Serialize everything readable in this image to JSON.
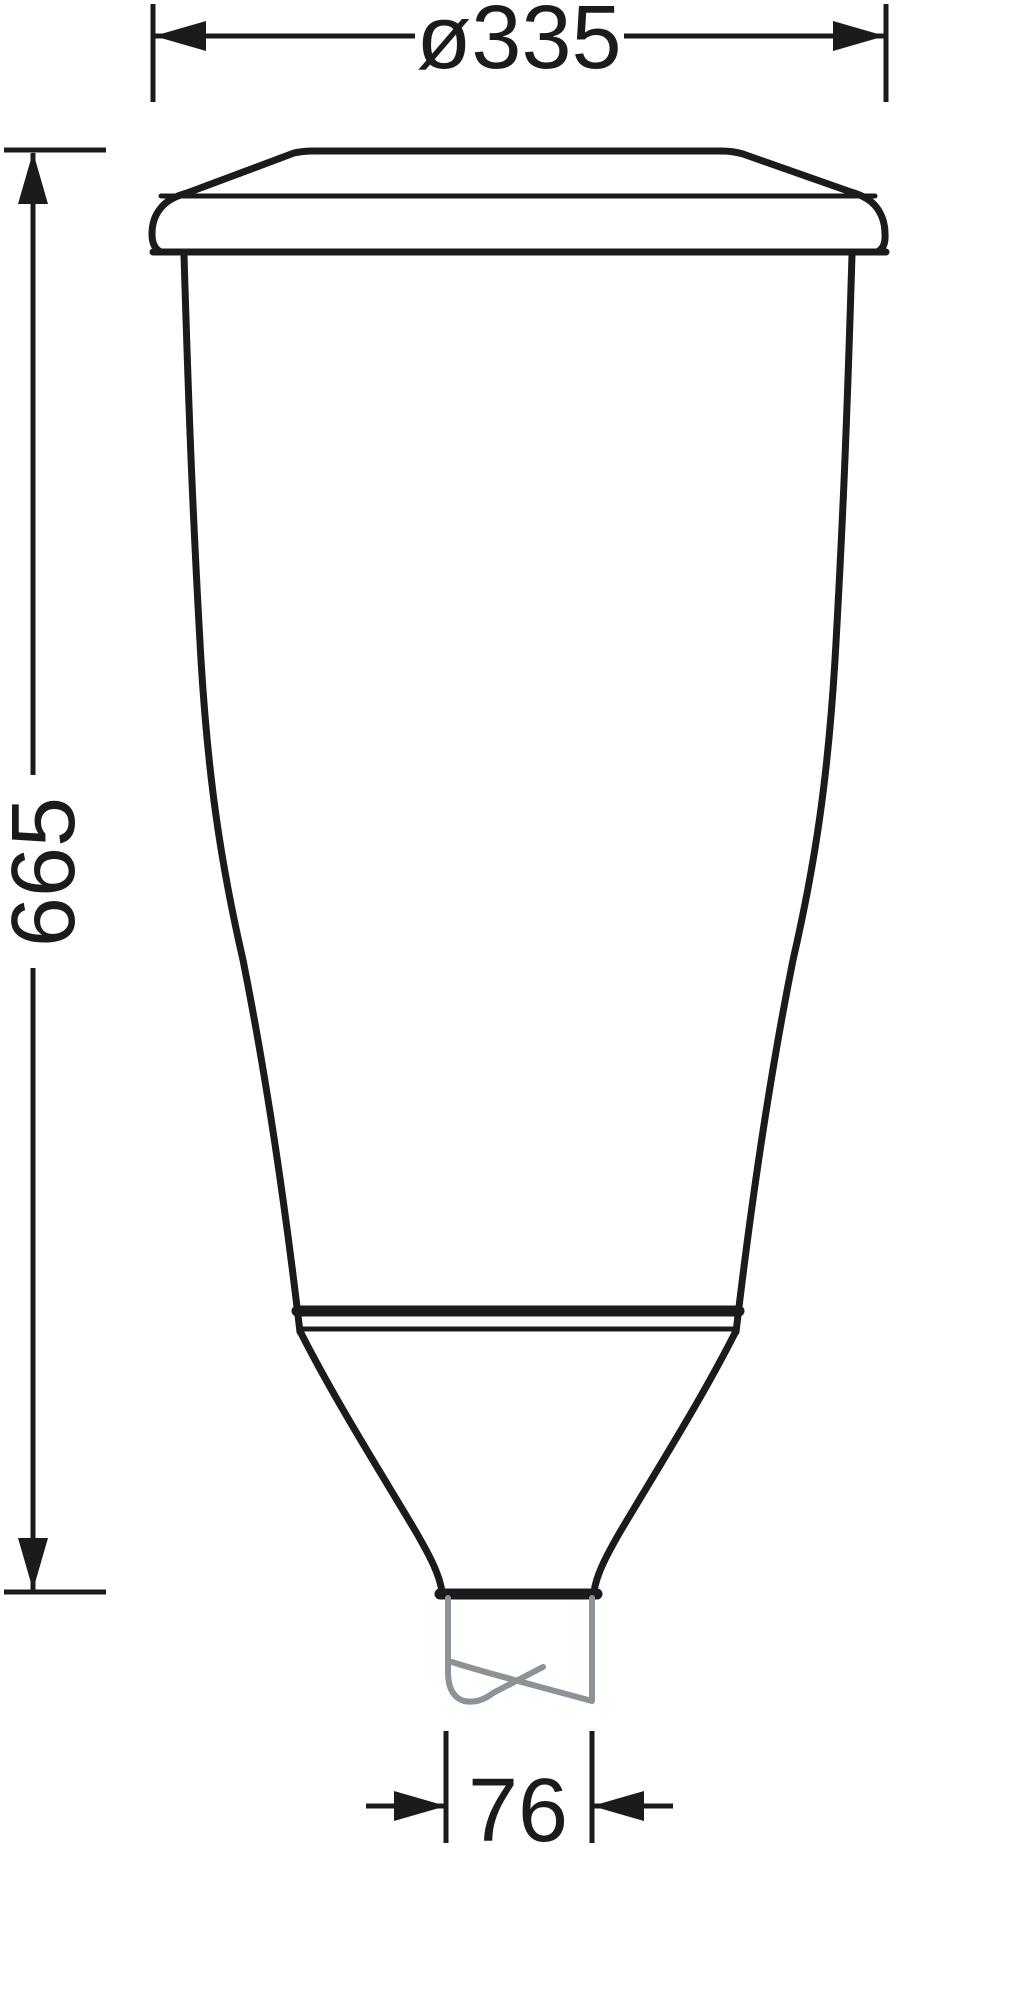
{
  "drawing": {
    "dimensions": {
      "top_width": "ø335",
      "left_height": "665",
      "bottom_width": "76"
    },
    "colors": {
      "line": "#1b1b1d",
      "pole": "#8b9298",
      "background": "#ffffff"
    }
  }
}
